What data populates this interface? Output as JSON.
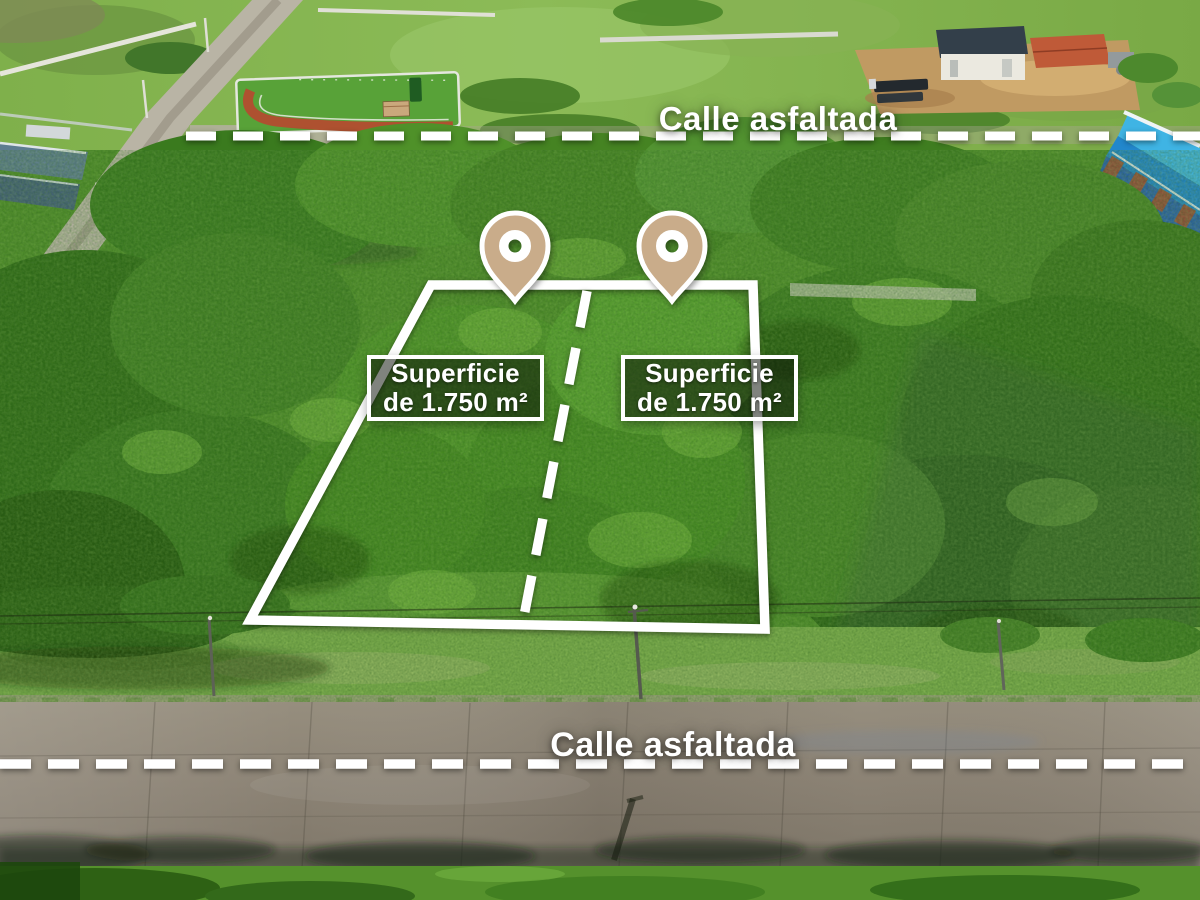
{
  "streets": {
    "top": {
      "label": "Calle asfaltada"
    },
    "bottom": {
      "label": "Calle asfaltada"
    }
  },
  "parcels": {
    "left": {
      "area_line1": "Superficie",
      "area_line2": "de 1.750 m²"
    },
    "right": {
      "area_line1": "Superficie",
      "area_line2": "de 1.750 m²"
    }
  },
  "markers": {
    "pin_color": "#C9AC8A"
  },
  "colors": {
    "overlay_white": "#FFFFFF"
  }
}
